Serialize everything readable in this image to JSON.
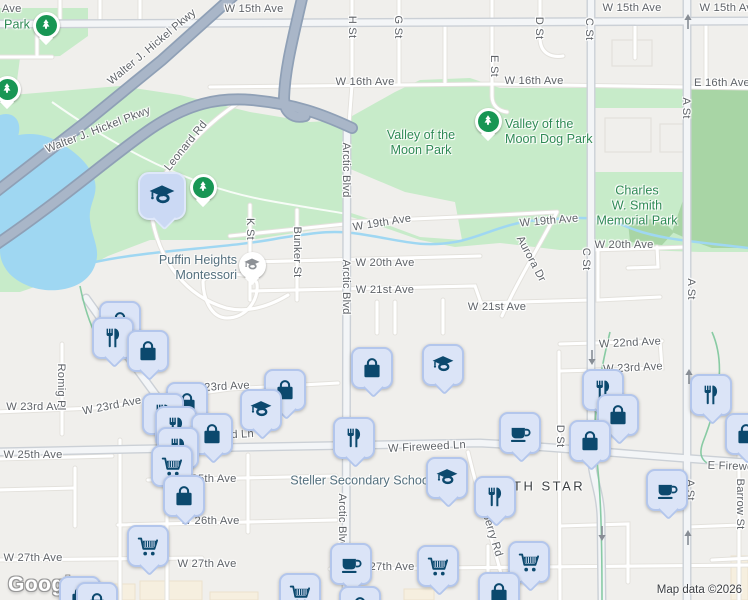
{
  "logo_text": "Google",
  "attribution": "Map data ©2026",
  "palette": {
    "land": "#f0efec",
    "park": "#c7ebc9",
    "forest": "#a8d5a5",
    "water": "#9fd7f2",
    "highway": "#a9b6c8",
    "poi_fill": "#dbe4f7",
    "poi_border": "#b3c6ec",
    "poi_icon": "#0c496e",
    "tree_pin_green": "#189654",
    "park_text": "#2f8a55",
    "school_text": "#54707e",
    "road_text": "#5f6368"
  },
  "road_labels": [
    {
      "t": "W 15th Ave",
      "x": -8,
      "y": 9
    },
    {
      "t": "W 15th Ave",
      "x": 254,
      "y": 9
    },
    {
      "t": "W 15th Ave",
      "x": 632,
      "y": 8
    },
    {
      "t": "W 15th Ave",
      "x": 729,
      "y": 8
    },
    {
      "t": "W 16th Ave",
      "x": 365,
      "y": 82
    },
    {
      "t": "W 16th Ave",
      "x": 534,
      "y": 81
    },
    {
      "t": "E 16th Ave",
      "x": 722,
      "y": 83
    },
    {
      "t": "W 19th Ave",
      "x": 382,
      "y": 223,
      "r": -9
    },
    {
      "t": "W 19th Ave",
      "x": 549,
      "y": 221,
      "r": -5
    },
    {
      "t": "W 20th Ave",
      "x": 385,
      "y": 263
    },
    {
      "t": "W 20th Ave",
      "x": 624,
      "y": 245
    },
    {
      "t": "W 21st Ave",
      "x": 385,
      "y": 290
    },
    {
      "t": "W 21st Ave",
      "x": 497,
      "y": 307
    },
    {
      "t": "W 22nd Ave",
      "x": 630,
      "y": 343,
      "r": -3
    },
    {
      "t": "W 23rd Ave",
      "x": 220,
      "y": 387,
      "r": -3
    },
    {
      "t": "W 23rd Ave",
      "x": 633,
      "y": 368,
      "r": -3
    },
    {
      "t": "W 23rd Ave",
      "x": 112,
      "y": 406,
      "r": -11
    },
    {
      "t": "W 23rd Ave",
      "x": 36,
      "y": 407
    },
    {
      "t": "W Fireweed Ln",
      "x": 427,
      "y": 447,
      "r": -3
    },
    {
      "t": "W Fireweed Ln",
      "x": 215,
      "y": 436,
      "r": -3
    },
    {
      "t": "E Fireweed Ln",
      "x": 745,
      "y": 467,
      "r": 2
    },
    {
      "t": "W 25th Ave",
      "x": 33,
      "y": 455
    },
    {
      "t": "W 25th Ave",
      "x": 207,
      "y": 479
    },
    {
      "t": "W 26th Ave",
      "x": 210,
      "y": 521
    },
    {
      "t": "W 27th Ave",
      "x": 33,
      "y": 558
    },
    {
      "t": "W 27th Ave",
      "x": 207,
      "y": 564
    },
    {
      "t": "W 27th Ave",
      "x": 385,
      "y": 567
    },
    {
      "t": "H St",
      "x": 352,
      "y": 27,
      "r": 90
    },
    {
      "t": "G St",
      "x": 398,
      "y": 27,
      "r": 90
    },
    {
      "t": "E St",
      "x": 494,
      "y": 66,
      "r": 90
    },
    {
      "t": "D St",
      "x": 539,
      "y": 28,
      "r": 90
    },
    {
      "t": "C St",
      "x": 589,
      "y": 29,
      "r": 90
    },
    {
      "t": "C St",
      "x": 586,
      "y": 259,
      "r": 90
    },
    {
      "t": "A St",
      "x": 686,
      "y": 108,
      "r": 90
    },
    {
      "t": "A St",
      "x": 691,
      "y": 289,
      "r": 90
    },
    {
      "t": "A St",
      "x": 690,
      "y": 490,
      "r": 90
    },
    {
      "t": "K St",
      "x": 250,
      "y": 229,
      "r": 90
    },
    {
      "t": "Bunker St",
      "x": 297,
      "y": 252,
      "r": 90
    },
    {
      "t": "Arctic Blvd",
      "x": 346,
      "y": 170,
      "r": 90
    },
    {
      "t": "Arctic Blvd",
      "x": 346,
      "y": 287,
      "r": 90
    },
    {
      "t": "Arctic Blvd",
      "x": 342,
      "y": 521,
      "r": 90
    },
    {
      "t": "Romig Pl",
      "x": 61,
      "y": 387,
      "r": 90
    },
    {
      "t": "D St",
      "x": 560,
      "y": 436,
      "r": 90
    },
    {
      "t": "Barrow St",
      "x": 740,
      "y": 504,
      "r": 90
    },
    {
      "t": "Aurora Dr",
      "x": 531,
      "y": 259,
      "r": 62
    },
    {
      "t": "Blueberry Rd",
      "x": 489,
      "y": 524,
      "r": 73
    },
    {
      "t": "Leonard Rd",
      "x": 186,
      "y": 146,
      "r": -51
    },
    {
      "t": "Walter J. Hickel Pkwy",
      "x": 152,
      "y": 47,
      "r": -40
    },
    {
      "t": "Walter J. Hickel Pkwy",
      "x": 98,
      "y": 130,
      "r": -21
    }
  ],
  "place_labels": [
    {
      "lines": [
        "Park"
      ],
      "x": 17,
      "y": 25,
      "cls": "park",
      "name": "park-label"
    },
    {
      "lines": [
        "Valley of the",
        "Moon Park"
      ],
      "x": 421,
      "y": 143,
      "cls": "park",
      "name": "valley-of-the-moon-park-label"
    },
    {
      "lines": [
        "Valley of the",
        "Moon Dog Park"
      ],
      "x": 505,
      "y": 132,
      "cls": "park",
      "align": "left",
      "name": "valley-of-the-moon-dog-park-label"
    },
    {
      "lines": [
        "Charles",
        "W. Smith",
        "Memorial Park"
      ],
      "x": 637,
      "y": 206,
      "cls": "park",
      "name": "charles-w-smith-memorial-park-label"
    },
    {
      "lines": [
        "Puffin Heights",
        "Montessori"
      ],
      "x": 237,
      "y": 268,
      "cls": "school",
      "align": "right",
      "name": "puffin-heights-montessori-label"
    },
    {
      "lines": [
        "Steller Secondary School"
      ],
      "x": 361,
      "y": 481,
      "cls": "school",
      "name": "steller-secondary-school-label"
    },
    {
      "lines": [
        "NORTH STAR"
      ],
      "x": 531,
      "y": 486,
      "cls": "district",
      "name": "north-star-district-label"
    }
  ],
  "markers": [
    {
      "type": "tree",
      "x": 46,
      "y": 25
    },
    {
      "type": "tree",
      "x": 7,
      "y": 89
    },
    {
      "type": "tree",
      "x": 488,
      "y": 121
    },
    {
      "type": "tree",
      "x": 203,
      "y": 187
    },
    {
      "type": "grad",
      "x": 162,
      "y": 196,
      "big": true
    },
    {
      "type": "school-pin",
      "x": 252,
      "y": 265
    },
    {
      "type": "bag",
      "x": 120,
      "y": 322
    },
    {
      "type": "fork",
      "x": 113,
      "y": 338
    },
    {
      "type": "bag",
      "x": 148,
      "y": 351
    },
    {
      "type": "grad",
      "x": 443,
      "y": 365
    },
    {
      "type": "bag",
      "x": 372,
      "y": 368
    },
    {
      "type": "fork",
      "x": 603,
      "y": 390
    },
    {
      "type": "bag",
      "x": 285,
      "y": 390
    },
    {
      "type": "fork",
      "x": 711,
      "y": 395
    },
    {
      "type": "bag",
      "x": 187,
      "y": 403
    },
    {
      "type": "grad",
      "x": 261,
      "y": 410
    },
    {
      "type": "fork",
      "x": 163,
      "y": 414
    },
    {
      "type": "bag",
      "x": 618,
      "y": 415
    },
    {
      "type": "fork",
      "x": 176,
      "y": 427
    },
    {
      "type": "coffee",
      "x": 520,
      "y": 433
    },
    {
      "type": "bag",
      "x": 212,
      "y": 434
    },
    {
      "type": "bag",
      "x": 746,
      "y": 434
    },
    {
      "type": "fork",
      "x": 354,
      "y": 438
    },
    {
      "type": "bag",
      "x": 590,
      "y": 441
    },
    {
      "type": "fork",
      "x": 178,
      "y": 448
    },
    {
      "type": "cart",
      "x": 172,
      "y": 466
    },
    {
      "type": "grad",
      "x": 447,
      "y": 478
    },
    {
      "type": "coffee",
      "x": 667,
      "y": 490
    },
    {
      "type": "bag",
      "x": 184,
      "y": 496
    },
    {
      "type": "fork",
      "x": 495,
      "y": 497
    },
    {
      "type": "cart",
      "x": 148,
      "y": 546
    },
    {
      "type": "cart",
      "x": 529,
      "y": 562
    },
    {
      "type": "coffee",
      "x": 351,
      "y": 564
    },
    {
      "type": "cart",
      "x": 438,
      "y": 566
    },
    {
      "type": "bag",
      "x": 499,
      "y": 593
    },
    {
      "type": "cart",
      "x": 300,
      "y": 594
    },
    {
      "type": "bag",
      "x": 80,
      "y": 597
    },
    {
      "type": "bag",
      "x": 97,
      "y": 603
    },
    {
      "type": "bag",
      "x": 360,
      "y": 607
    }
  ],
  "marker_type_names": {
    "bag": "shopping-bag",
    "fork": "restaurant",
    "cart": "supermarket",
    "coffee": "cafe",
    "grad": "school",
    "tree": "park-tree",
    "school-pin": "school"
  },
  "one_way_arrows": [
    {
      "x": 688,
      "y": 22,
      "dir": "up"
    },
    {
      "x": 689,
      "y": 377,
      "dir": "up"
    },
    {
      "x": 688,
      "y": 538,
      "dir": "up"
    },
    {
      "x": 592,
      "y": 357,
      "dir": "down"
    },
    {
      "x": 602,
      "y": 533,
      "dir": "down"
    }
  ]
}
